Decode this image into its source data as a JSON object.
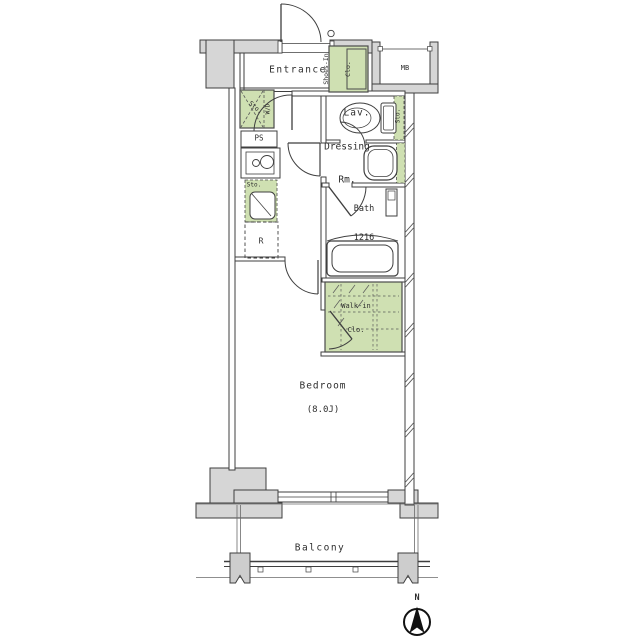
{
  "floorplan": {
    "rooms": {
      "entrance": "Entrance",
      "shoes_closet_line1": "Shoes-In",
      "shoes_closet_line2": "Clo.",
      "meter_box": "MB",
      "storage_hall": "Sto.",
      "washer_dryer": "W/D",
      "pipe_space": "PS",
      "storage_kitchen": "Sto.",
      "refrigerator": "R",
      "lavatory": "Lav.",
      "storage_lav": "Sto.",
      "dressing_line1": "Dressing",
      "dressing_line2": "Rm.",
      "bath_line1": "Bath",
      "bath_line2": "1216",
      "walkin_line1": "Walk-in",
      "walkin_line2": "Clo.",
      "bedroom": "Bedroom",
      "bedroom_size": "(8.0J)",
      "balcony": "Balcony"
    },
    "compass": {
      "north": "N"
    },
    "colors": {
      "wall_fill": "#d6d6d6",
      "accent_green": "#cfe0b2",
      "line": "#3f3f3f"
    }
  }
}
